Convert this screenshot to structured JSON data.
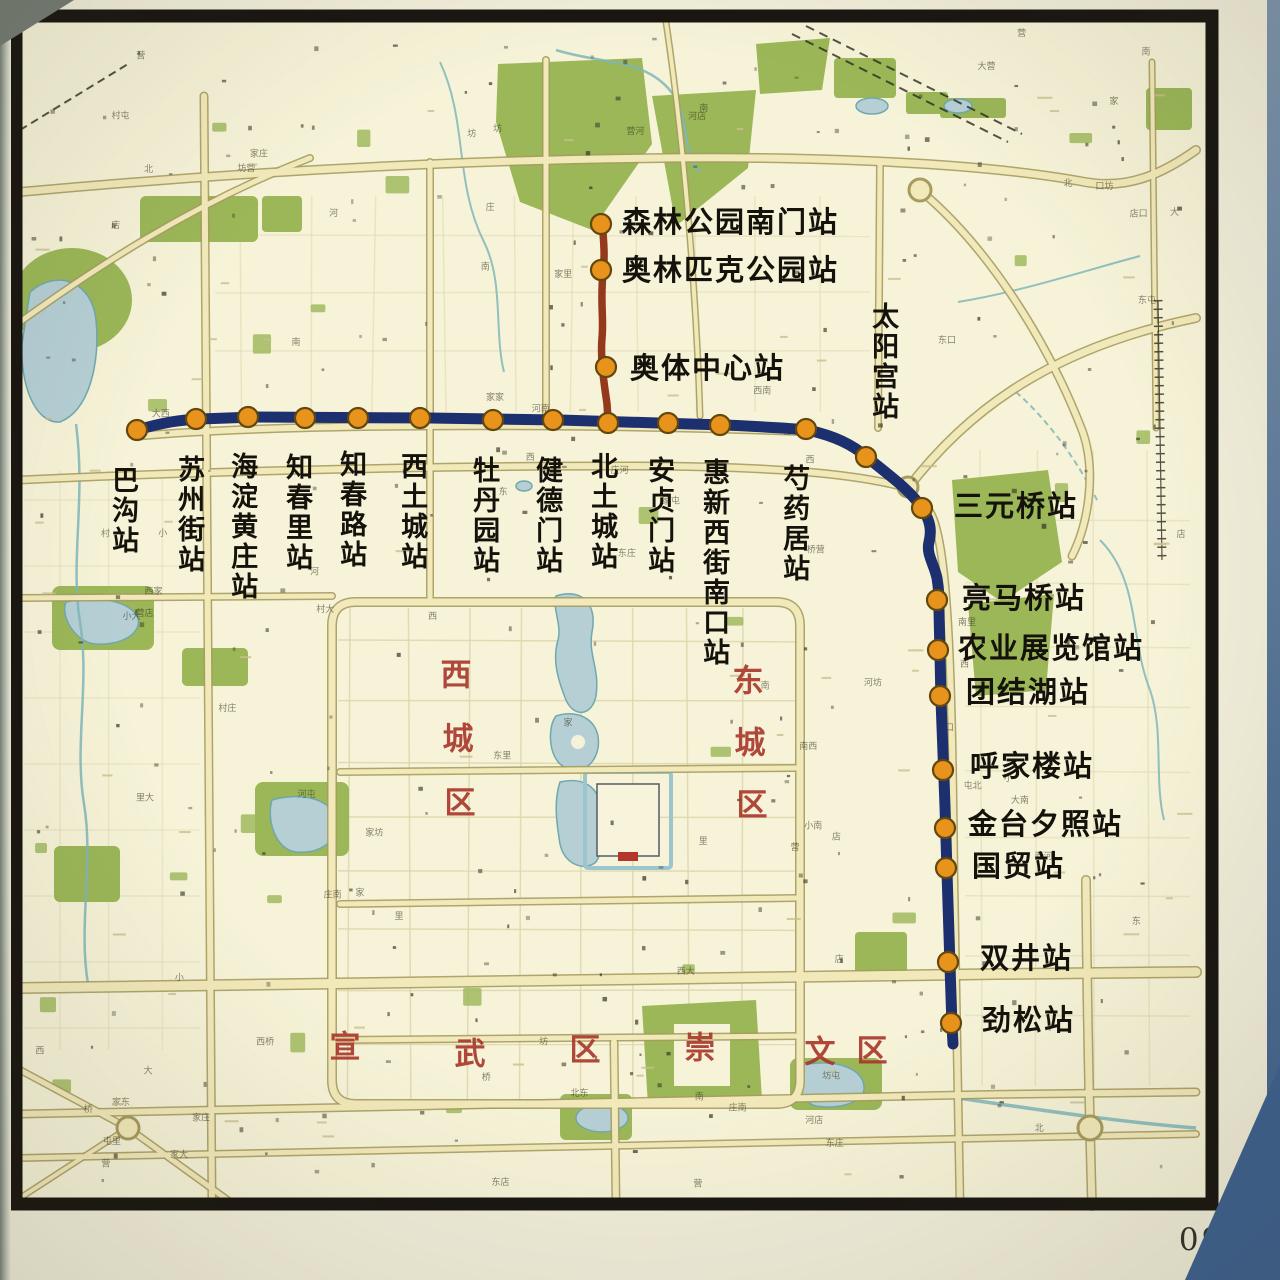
{
  "page": {
    "number": "099"
  },
  "colors": {
    "metro_line": "#1c2f6e",
    "metro_branch": "#94391c",
    "station_dot": "#e8931b",
    "station_dot_ring": "#63470e",
    "station_label": "#14120a",
    "district_label": "#a8362b",
    "map_frame": "#191511"
  },
  "line": {
    "main_path": "M137,430 C165,422 180,420 200,419 L255,417 L430,418 L560,420 L690,424 L726,425 C765,427 788,428 808,430 C834,436 852,444 868,458 C890,476 910,490 922,508 C930,520 932,530 929,542 C926,554 934,564 937,578 C939,590 939,598 939,610 L941,700 L945,806 L947,872 L950,966 L952,1026 L953,1044",
    "branch_path": "M602,222 C604,242 605,258 603,274 C600,302 604,318 602,338 C600,362 605,388 607,404 L608,420"
  },
  "stations": [
    {
      "name": "森林公园南门站",
      "x": 601,
      "y": 224,
      "lx": 622,
      "ly": 224,
      "align": "h"
    },
    {
      "name": "奥林匹克公园站",
      "x": 601,
      "y": 270,
      "lx": 622,
      "ly": 272,
      "align": "h"
    },
    {
      "name": "奥体中心站",
      "x": 606,
      "y": 367,
      "lx": 630,
      "ly": 370,
      "align": "h"
    },
    {
      "name": "巴沟站",
      "x": 137,
      "y": 430,
      "lx": 124,
      "ly": 466,
      "align": "v"
    },
    {
      "name": "苏州街站",
      "x": 196,
      "y": 419,
      "lx": 190,
      "ly": 455,
      "align": "v"
    },
    {
      "name": "海淀黄庄站",
      "x": 248,
      "y": 417,
      "lx": 243,
      "ly": 452,
      "align": "v"
    },
    {
      "name": "知春里站",
      "x": 305,
      "y": 418,
      "lx": 298,
      "ly": 453,
      "align": "v"
    },
    {
      "name": "知春路站",
      "x": 358,
      "y": 418,
      "lx": 352,
      "ly": 450,
      "align": "v"
    },
    {
      "name": "西土城站",
      "x": 420,
      "y": 418,
      "lx": 413,
      "ly": 452,
      "align": "v"
    },
    {
      "name": "牡丹园站",
      "x": 493,
      "y": 420,
      "lx": 485,
      "ly": 456,
      "align": "v"
    },
    {
      "name": "健德门站",
      "x": 553,
      "y": 420,
      "lx": 548,
      "ly": 456,
      "align": "v"
    },
    {
      "name": "北土城站",
      "x": 608,
      "y": 423,
      "lx": 603,
      "ly": 452,
      "align": "v"
    },
    {
      "name": "安贞门站",
      "x": 668,
      "y": 423,
      "lx": 660,
      "ly": 456,
      "align": "v"
    },
    {
      "name": "惠新西街南口站",
      "x": 720,
      "y": 425,
      "lx": 715,
      "ly": 458,
      "align": "v"
    },
    {
      "name": "芍药居站",
      "x": 806,
      "y": 429,
      "lx": 795,
      "ly": 464,
      "align": "v"
    },
    {
      "name": "太阳宫站",
      "x": 866,
      "y": 457,
      "lx": 884,
      "ly": 302,
      "align": "v"
    },
    {
      "name": "三元桥站",
      "x": 922,
      "y": 508,
      "lx": 954,
      "ly": 508,
      "align": "h"
    },
    {
      "name": "亮马桥站",
      "x": 937,
      "y": 600,
      "lx": 962,
      "ly": 600,
      "align": "h"
    },
    {
      "name": "农业展览馆站",
      "x": 938,
      "y": 650,
      "lx": 958,
      "ly": 650,
      "align": "h"
    },
    {
      "name": "团结湖站",
      "x": 940,
      "y": 696,
      "lx": 966,
      "ly": 694,
      "align": "h"
    },
    {
      "name": "呼家楼站",
      "x": 943,
      "y": 770,
      "lx": 970,
      "ly": 768,
      "align": "h"
    },
    {
      "name": "金台夕照站",
      "x": 945,
      "y": 828,
      "lx": 968,
      "ly": 826,
      "align": "h"
    },
    {
      "name": "国贸站",
      "x": 946,
      "y": 868,
      "lx": 972,
      "ly": 868,
      "align": "h"
    },
    {
      "name": "双井站",
      "x": 948,
      "y": 962,
      "lx": 980,
      "ly": 960,
      "align": "h"
    },
    {
      "name": "劲松站",
      "x": 951,
      "y": 1023,
      "lx": 982,
      "ly": 1022,
      "align": "h"
    }
  ],
  "districts": [
    {
      "id": "xicheng",
      "chars": [
        {
          "ch": "西",
          "x": 456,
          "y": 672
        },
        {
          "ch": "城",
          "x": 458,
          "y": 736
        },
        {
          "ch": "区",
          "x": 460,
          "y": 800
        }
      ]
    },
    {
      "id": "dongcheng",
      "chars": [
        {
          "ch": "东",
          "x": 748,
          "y": 678
        },
        {
          "ch": "城",
          "x": 750,
          "y": 740
        },
        {
          "ch": "区",
          "x": 752,
          "y": 802
        }
      ]
    },
    {
      "id": "xuanwu",
      "chars": [
        {
          "ch": "宣",
          "x": 345,
          "y": 1044
        },
        {
          "ch": "武",
          "x": 470,
          "y": 1051
        },
        {
          "ch": "区",
          "x": 585,
          "y": 1047
        }
      ]
    },
    {
      "id": "chongwen",
      "chars": [
        {
          "ch": "崇",
          "x": 700,
          "y": 1045
        },
        {
          "ch": "文",
          "x": 820,
          "y": 1049
        },
        {
          "ch": "区",
          "x": 872,
          "y": 1048
        }
      ]
    }
  ]
}
